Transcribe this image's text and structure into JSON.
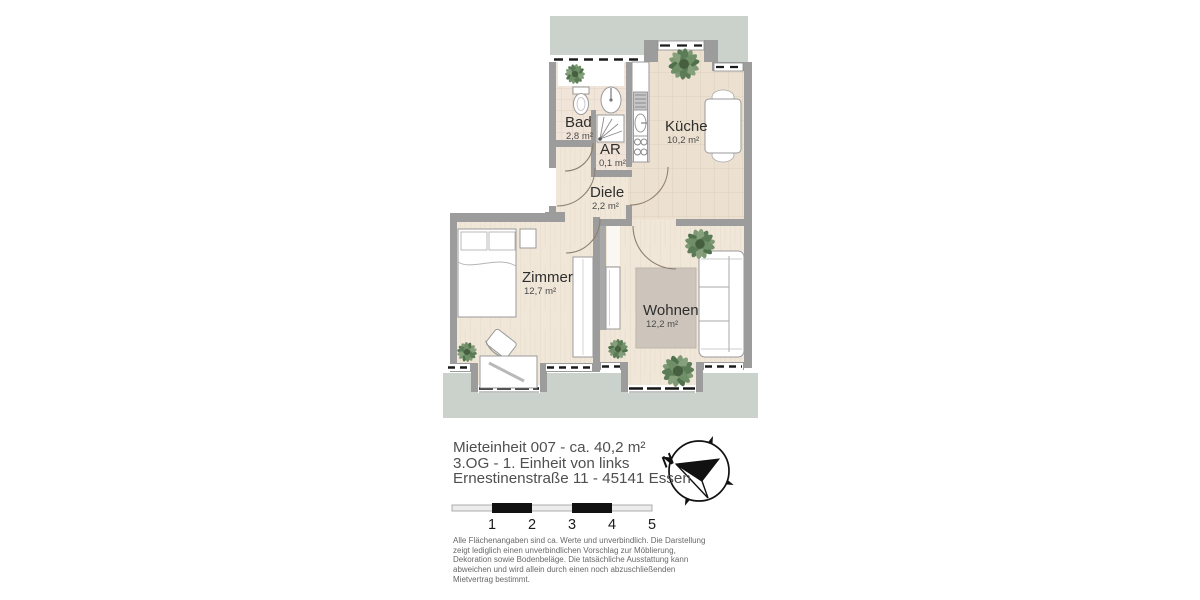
{
  "header": {
    "unit": "Mieteinheit 007 - ca. 40,2 m²",
    "floor": "3.OG - 1. Einheit von links",
    "address": "Ernestinenstraße 11 - 45141 Essen"
  },
  "rooms": {
    "bad": {
      "name": "Bad",
      "area": "2,8 m²"
    },
    "ar": {
      "name": "AR",
      "area": "0,1 m²"
    },
    "kueche": {
      "name": "Küche",
      "area": "10,2 m²"
    },
    "diele": {
      "name": "Diele",
      "area": "2,2 m²"
    },
    "zimmer": {
      "name": "Zimmer",
      "area": "12,7 m²"
    },
    "wohnen": {
      "name": "Wohnen",
      "area": "12,2 m²"
    }
  },
  "compass": {
    "north_label": "N"
  },
  "scale_bar": {
    "ticks": [
      "1",
      "2",
      "3",
      "4",
      "5"
    ]
  },
  "disclaimer": "Alle Flächenangaben sind ca. Werte und unverbindlich. Die Darstellung\nzeigt lediglich einen unverbindlichen Vorschlag zur Möblierung,\nDekoration sowie Bodenbeläge. Die tatsächliche  Ausstattung kann\nabweichen und wird allein durch einen noch abzuschließenden\nMietvertrag bestimmt.",
  "colors": {
    "exterior": "#cbd2cb",
    "wall": "#9c9c9c",
    "wood_floor": "#f0e7d9",
    "tile_floor": "#f1e5d9",
    "rug": "#cdc5bc",
    "plant": "#6f8f68"
  }
}
